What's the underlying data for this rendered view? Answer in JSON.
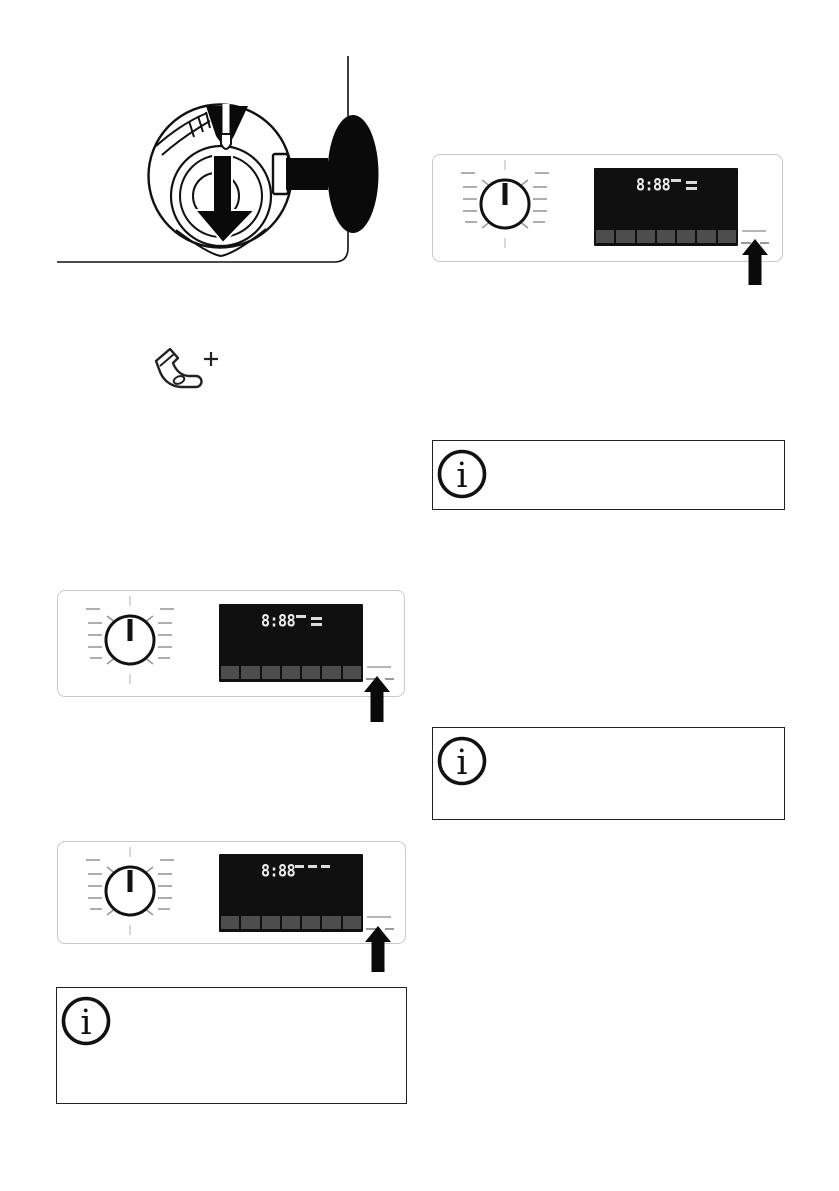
{
  "document": {
    "type": "appliance-manual-page",
    "background": "#ffffff",
    "visible_text_note": "page contains only figures, no body text"
  },
  "figures": {
    "drain_pump_figure": {
      "elements": [
        "washing-machine-corner-outline",
        "magnifier-detail-circle",
        "nozzle",
        "big-down-arrow",
        "pump-cap-arcs",
        "black-oval-knob"
      ]
    },
    "extra_items_icon": {
      "glyph": "sock-plus"
    }
  },
  "panels": [
    {
      "name": "panel-right-top",
      "display": {
        "time": "8:88",
        "segments": [
          "dash",
          "equals-top",
          "equals-bottom"
        ]
      },
      "button_count": 7,
      "callout": "up-arrow-pointing-at-right-side-button"
    },
    {
      "name": "panel-left-middle",
      "display": {
        "time": "8:88",
        "segments": [
          "dash",
          "equals-top",
          "equals-bottom"
        ]
      },
      "button_count": 7,
      "callout": "up-arrow-pointing-at-right-side-button"
    },
    {
      "name": "panel-left-bottom",
      "display": {
        "time": "8:88",
        "segments": [
          "dash",
          "dash",
          "dash"
        ]
      },
      "button_count": 7,
      "callout": "up-arrow-pointing-at-right-side-button"
    }
  ],
  "info_boxes": [
    {
      "position": "left-bottom",
      "icon_glyph": "i"
    },
    {
      "position": "right-upper",
      "icon_glyph": "i"
    },
    {
      "position": "right-lower",
      "icon_glyph": "i"
    }
  ],
  "colors": {
    "ink": "#111111",
    "panel_border": "#c9c9c9",
    "display_bg": "#101010",
    "display_button": "#4d4d4d",
    "digit": "#ececec",
    "tick": "#9a9a9a",
    "indicator_dash": "#b5b5b5"
  }
}
